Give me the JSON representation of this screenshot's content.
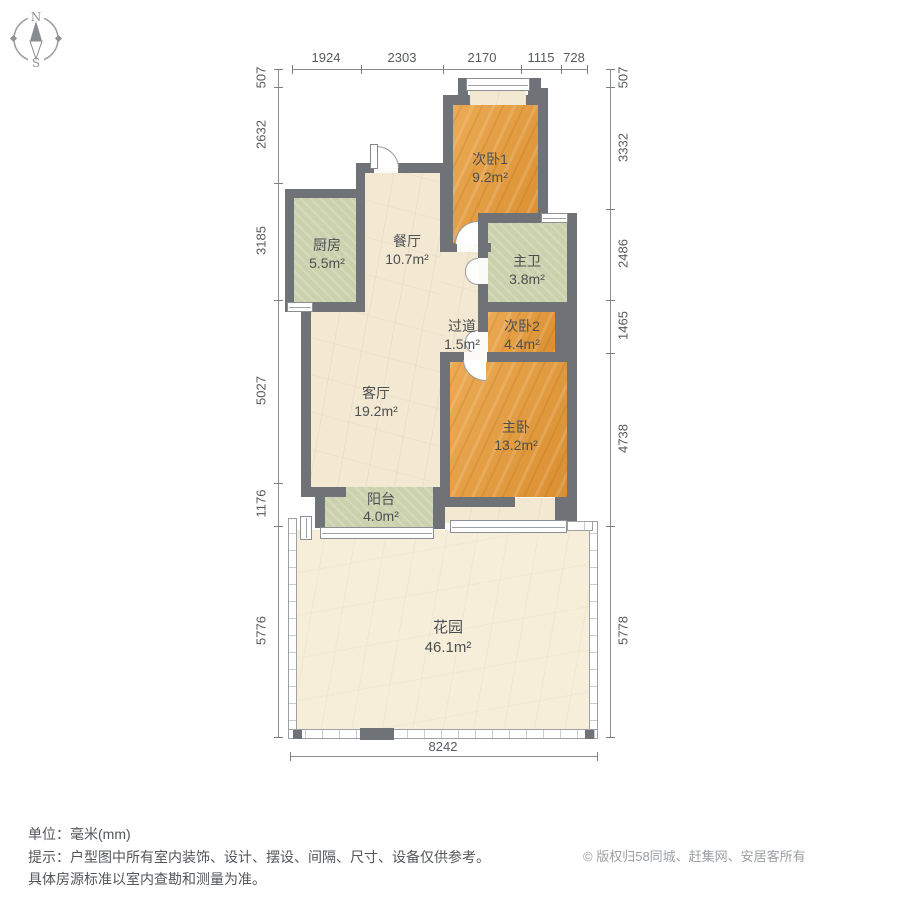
{
  "compass": {
    "north": "N",
    "south": "S"
  },
  "dimensions": {
    "unit": "mm",
    "top": [
      "1924",
      "2303",
      "2170",
      "1115",
      "728"
    ],
    "left": [
      "507",
      "2632",
      "3185",
      "5027",
      "1176",
      "5776"
    ],
    "right": [
      "507",
      "3332",
      "2486",
      "1465",
      "4738",
      "5778"
    ],
    "bottom": [
      "8242"
    ]
  },
  "rooms": [
    {
      "name": "次卧1",
      "area": "9.2m²"
    },
    {
      "name": "厨房",
      "area": "5.5m²"
    },
    {
      "name": "餐厅",
      "area": "10.7m²"
    },
    {
      "name": "主卫",
      "area": "3.8m²"
    },
    {
      "name": "过道",
      "area": "1.5m²"
    },
    {
      "name": "次卧2",
      "area": "4.4m²"
    },
    {
      "name": "客厅",
      "area": "19.2m²"
    },
    {
      "name": "主卧",
      "area": "13.2m²"
    },
    {
      "name": "阳台",
      "area": "4.0m²"
    },
    {
      "name": "花园",
      "area": "46.1m²"
    }
  ],
  "footer": {
    "unit_line": "单位：毫米(mm)",
    "tip_line1": "提示：户型图中所有室内装饰、设计、摆设、间隔、尺寸、设备仅供参考。",
    "tip_line2": "具体房源标准以室内查勘和测量为准。",
    "copyright_icon": "©",
    "copyright": "版权归58同城、赶集网、安居客所有"
  },
  "colors": {
    "wall": "#6f7377",
    "floor_wood": "#e2a047",
    "floor_tile_green": "#cbd1ad",
    "floor_marble": "#f3e8d2",
    "garden": "#f6eed9",
    "dim_text": "#565a5e",
    "copyright_text": "#9b9ea3"
  }
}
